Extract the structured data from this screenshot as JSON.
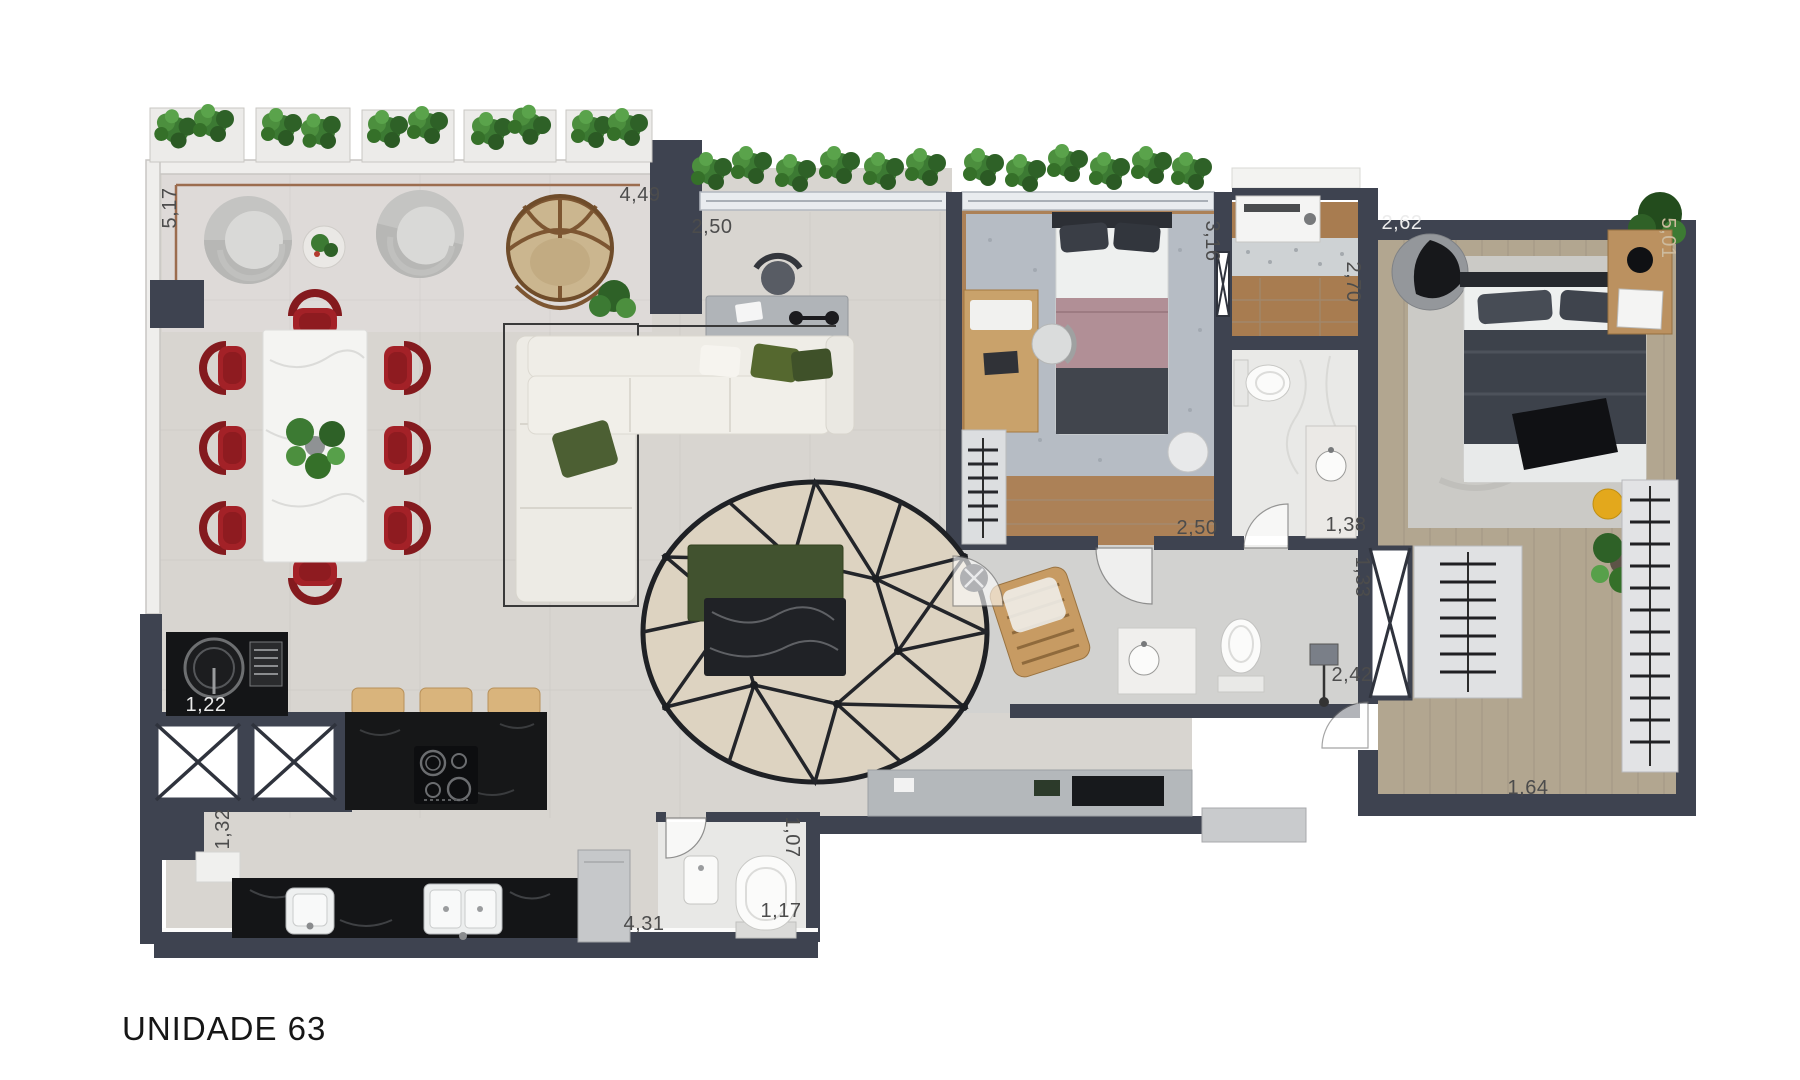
{
  "title": "UNIDADE 63",
  "dimensions": [
    {
      "id": "terrace-side",
      "text": "5,17"
    },
    {
      "id": "terrace-front",
      "text": "4,49"
    },
    {
      "id": "balcony-depth",
      "text": "2,50"
    },
    {
      "id": "bedroom2-length",
      "text": "3,16"
    },
    {
      "id": "laundry-length",
      "text": "2,70"
    },
    {
      "id": "master-width",
      "text": "2,62"
    },
    {
      "id": "master-length",
      "text": "5,01"
    },
    {
      "id": "bedroom2-width",
      "text": "2,50"
    },
    {
      "id": "bath1-width",
      "text": "1,38"
    },
    {
      "id": "hall-width",
      "text": "1,33"
    },
    {
      "id": "bath2-width",
      "text": "2,42"
    },
    {
      "id": "closet-width",
      "text": "1,64"
    },
    {
      "id": "grill-width",
      "text": "1,22"
    },
    {
      "id": "service-width",
      "text": "1,32"
    },
    {
      "id": "kitchen-length",
      "text": "4,31"
    },
    {
      "id": "lavabo-depth",
      "text": "1,07"
    },
    {
      "id": "lavabo-width",
      "text": "1,17"
    }
  ],
  "colors": {
    "wall": "#3e4350",
    "floor_living": "#d8d5d0",
    "floor_wood": "#a97f52",
    "floor_wood_master": "#b2a690",
    "rug_oval": "#ddd3c1",
    "accent_red_chairs": "#a32127",
    "plant_green": "#3c7a33",
    "counter_black": "#17181a",
    "stool_wood": "#d9b47c",
    "accent_yellow_stool": "#e3a81c"
  }
}
